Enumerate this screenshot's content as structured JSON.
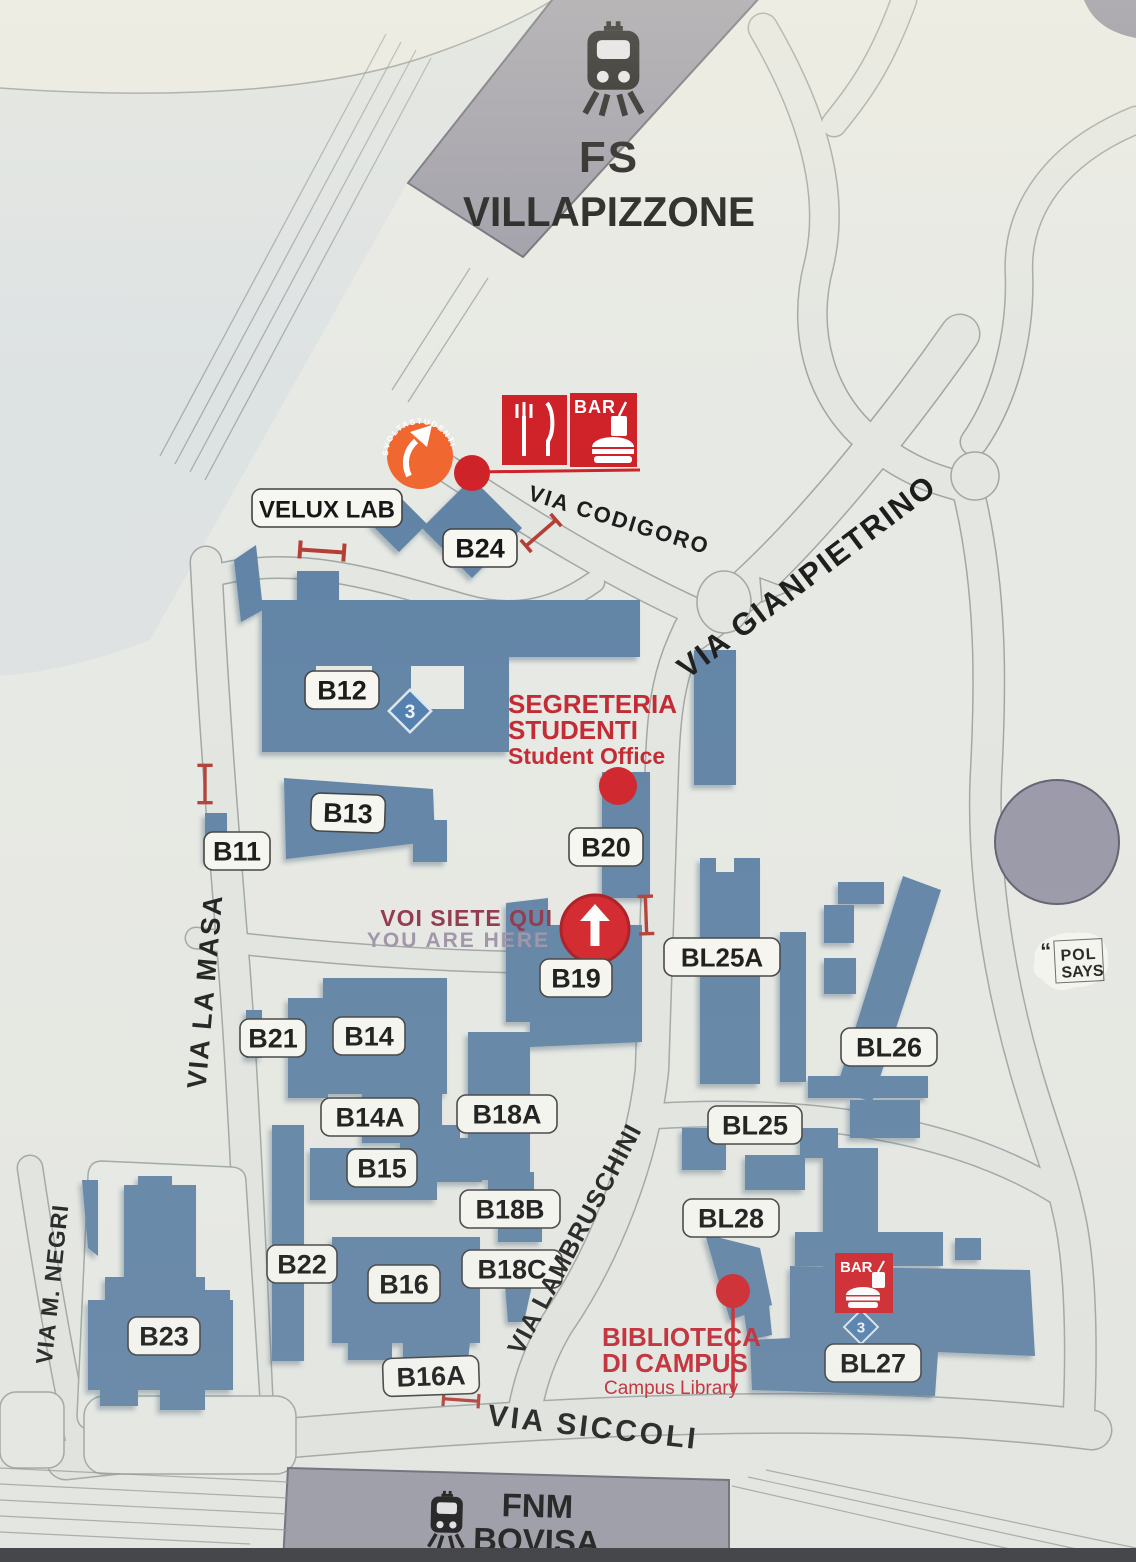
{
  "title": "Campus map sign — Bovisa",
  "colors": {
    "background": "#e7e9e4",
    "road_fill": "#e3e6e1",
    "road_edge": "#a0a6a3",
    "rail_yard": "#dde2e3",
    "building_blue": "#5e82a5",
    "station_gray": "#9b9aa6",
    "accent_red": "#cf2128",
    "barrier_red": "#b23c34",
    "badge_orange": "#f0662f",
    "label_bg": "#f7f7f2"
  },
  "stations": [
    {
      "id": "fs-villapizzone",
      "line1": "FS",
      "line2": "VILLAPIZZONE"
    },
    {
      "id": "fnm-bovisa",
      "line1": "FNM",
      "line2": "BOVISA"
    }
  ],
  "streets": [
    {
      "id": "via-codigoro",
      "name": "VIA CODIGORO"
    },
    {
      "id": "via-gianpietrino",
      "name": "VIA GIANPIETRINO"
    },
    {
      "id": "via-la-masa",
      "name": "VIA LA MASA"
    },
    {
      "id": "via-lambruschini",
      "name": "VIA LAMBRUSCHINI"
    },
    {
      "id": "via-m-negri",
      "name": "VIA M. NEGRI"
    },
    {
      "id": "via-siccoli",
      "name": "VIA SICCOLI"
    }
  ],
  "buildings": [
    {
      "id": "velux-lab",
      "label": "VELUX LAB"
    },
    {
      "id": "b24",
      "label": "B24"
    },
    {
      "id": "b12",
      "label": "B12"
    },
    {
      "id": "b13",
      "label": "B13"
    },
    {
      "id": "b11",
      "label": "B11"
    },
    {
      "id": "b20",
      "label": "B20"
    },
    {
      "id": "b19",
      "label": "B19"
    },
    {
      "id": "b21",
      "label": "B21"
    },
    {
      "id": "b14",
      "label": "B14"
    },
    {
      "id": "b14a",
      "label": "B14A"
    },
    {
      "id": "b18a",
      "label": "B18A"
    },
    {
      "id": "b15",
      "label": "B15"
    },
    {
      "id": "b18b",
      "label": "B18B"
    },
    {
      "id": "b22",
      "label": "B22"
    },
    {
      "id": "b18c",
      "label": "B18C"
    },
    {
      "id": "b16",
      "label": "B16"
    },
    {
      "id": "b16a",
      "label": "B16A"
    },
    {
      "id": "b23",
      "label": "B23"
    },
    {
      "id": "bl25a",
      "label": "BL25A"
    },
    {
      "id": "bl26",
      "label": "BL26"
    },
    {
      "id": "bl25",
      "label": "BL25"
    },
    {
      "id": "bl28",
      "label": "BL28"
    },
    {
      "id": "bl27",
      "label": "BL27"
    }
  ],
  "pois": {
    "segreteria": {
      "line1": "SEGRETERIA",
      "line2": "STUDENTI",
      "en": "Student Office"
    },
    "biblioteca": {
      "line1": "BIBLIOTECA",
      "line2": "DI CAMPUS",
      "en": "Campus Library"
    },
    "you_are_here": {
      "it": "VOI SIETE QUI",
      "en": "YOU ARE HERE"
    },
    "bar": {
      "label": "BAR"
    },
    "svolta": {
      "label": "SVOLTASTUDENTI"
    }
  },
  "icons": {
    "diamond_glyph": "3"
  },
  "sticker": {
    "quote": "“",
    "line1": "POL",
    "line2": "SAYS"
  }
}
